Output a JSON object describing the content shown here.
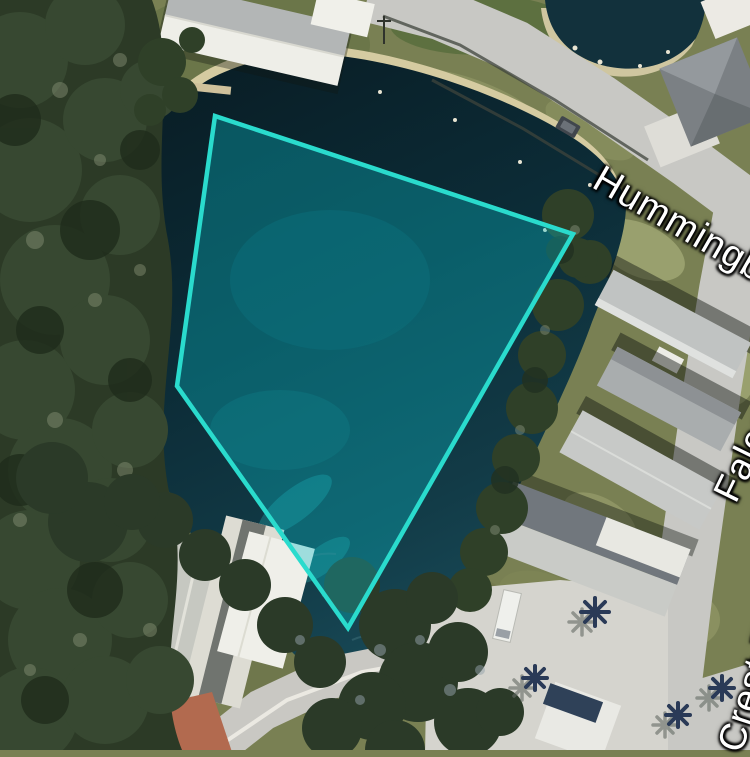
{
  "map_view": {
    "type": "aerial-satellite-parcel-view",
    "width_px": 750,
    "height_px": 750
  },
  "street_labels": {
    "hummingbird": "Hummingbird",
    "falcon": "Falcon",
    "crest": "Crest F"
  },
  "parcel_overlay": {
    "points": "215,116 573,234 348,628 177,386",
    "vertices": [
      [
        215,
        116
      ],
      [
        573,
        234
      ],
      [
        348,
        628
      ],
      [
        177,
        386
      ]
    ],
    "stroke_color": "#2adbcd",
    "fill_color": "rgba(10,190,200,0.35)",
    "stroke_width": "4.5"
  },
  "palette": {
    "grass": "#798053",
    "sand_shore": "#d5cba1",
    "water_dark": "#0a2129",
    "water_light": "#1a4e5c",
    "road": "#c8c8c4",
    "forest": "#2c3a26",
    "roof_white": "#eeeee8",
    "roof_gray": "#b9bcbc",
    "palm": "#2a3a57",
    "label_text": "#ffffff"
  }
}
